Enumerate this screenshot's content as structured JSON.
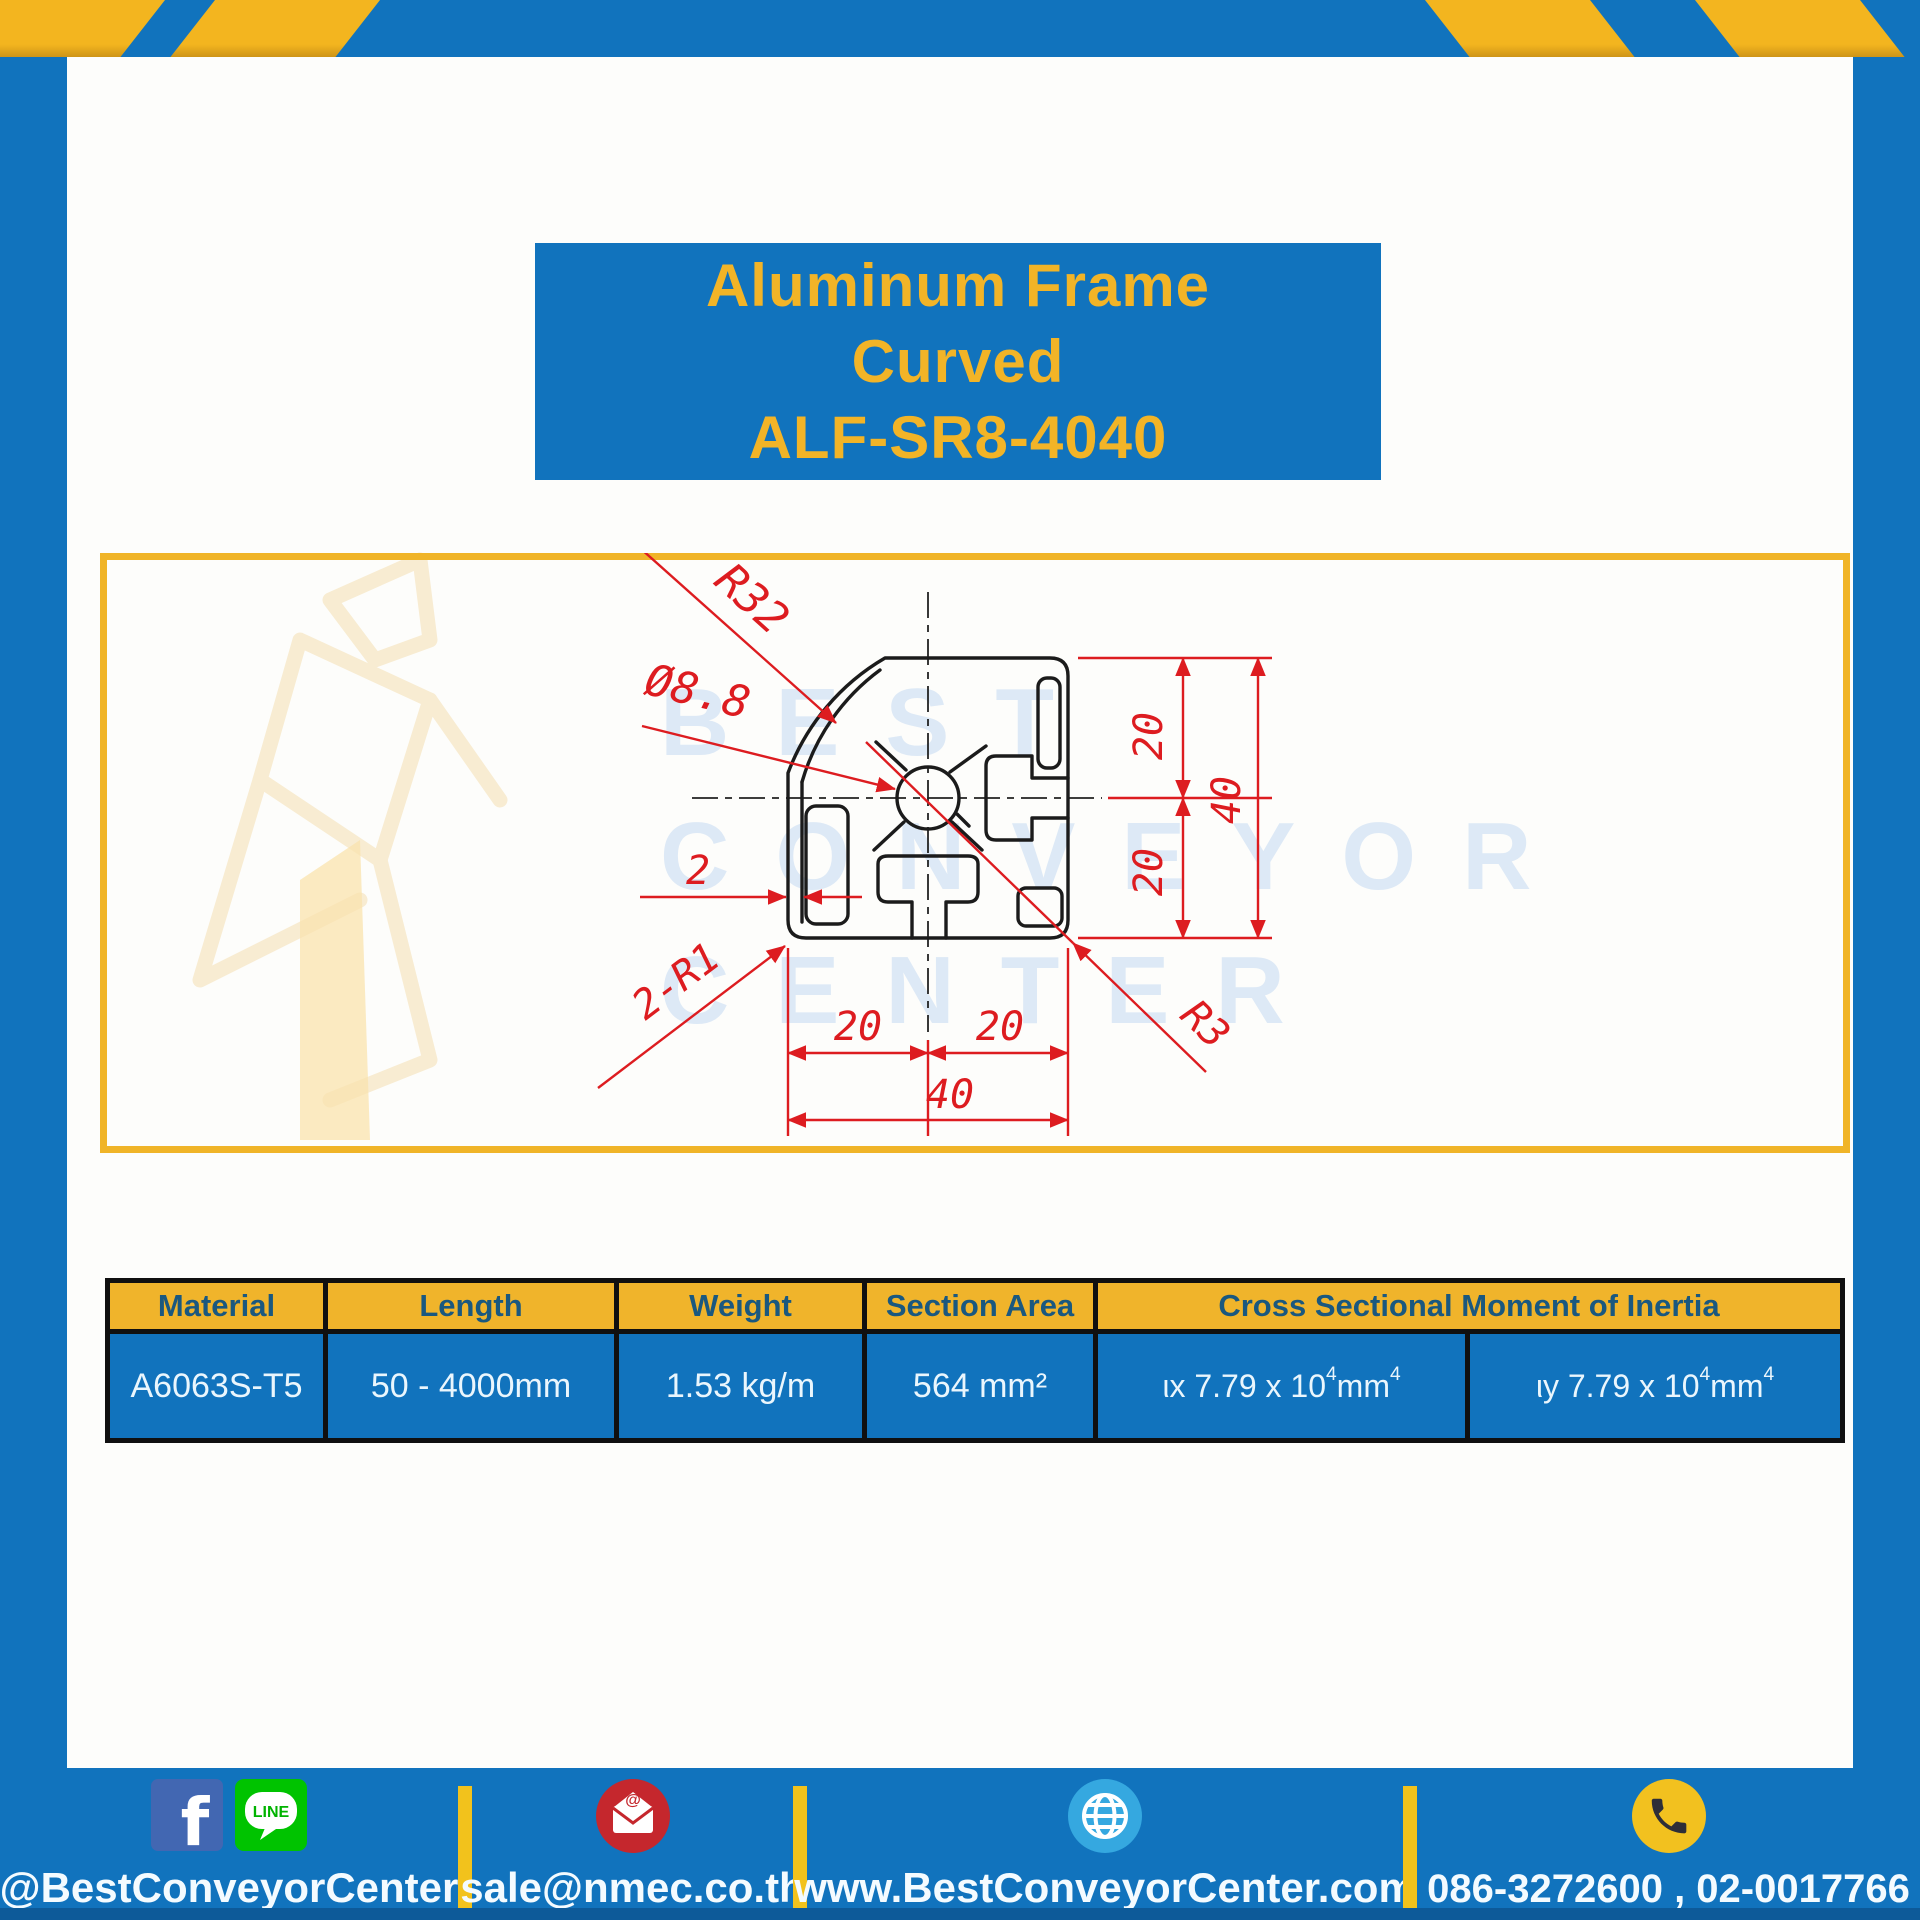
{
  "colors": {
    "frame_blue": "#1173bd",
    "accent_yellow": "#f0b428",
    "dimension_red": "#dd1c20",
    "header_text_blue": "#1a587f",
    "watermark_blue": "#dde9f6"
  },
  "title_box": {
    "line1": "Aluminum Frame",
    "line2": "Curved",
    "line3": "ALF-SR8-4040"
  },
  "watermark": {
    "row1": "BEST",
    "row2": "CONVEYOR",
    "row3": "CENTER"
  },
  "drawing": {
    "labels": {
      "radius_outer": "R32",
      "bore_dia": "Ø8.8",
      "wall": "2",
      "corner_r1": "2-R1",
      "corner_r3": "R3",
      "h20_left": "20",
      "h20_right": "20",
      "h40": "40",
      "v20_top": "20",
      "v20_bottom": "20",
      "v40": "40"
    }
  },
  "table": {
    "headers": [
      "Material",
      "Length",
      "Weight",
      "Section Area",
      "Cross Sectional Moment of Inertia"
    ],
    "row": {
      "material": "A6063S-T5",
      "length": "50 - 4000mm",
      "weight": "1.53 kg/m",
      "section_area": "564 mm²",
      "inertia_x": {
        "base": "ιx 7.79 x 10",
        "exp": "4",
        "unit": " mm",
        "unit_exp": "4"
      },
      "inertia_y": {
        "base": "ιy 7.79 x 10",
        "exp": "4",
        "unit": " mm",
        "unit_exp": "4"
      }
    }
  },
  "footer": {
    "social_handle": "@BestConveyorCenter",
    "line_label": "LINE",
    "email": "sale@nmec.co.th",
    "website": "www.BestConveyorCenter.com",
    "phones": "086-3272600 , 02-0017766"
  }
}
